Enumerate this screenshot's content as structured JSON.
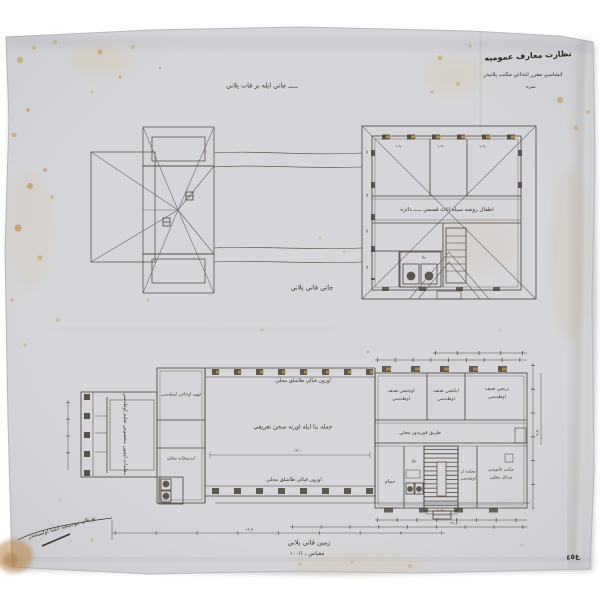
{
  "document": {
    "type": "scanned architectural drawing (Ottoman school plan)",
    "paper_color": "#d6d6da",
    "ink_color": "#463e34",
    "stain_color": "#c59a55",
    "background": "#ffffff"
  },
  "header": {
    "line1": "نظارت معارف عموميه",
    "line2": "انشاسي مقرر ابتدائي مكتب پلانيدر",
    "line3": "نمره"
  },
  "captions": {
    "top": "ـــــ چاتي ايله بر قات پلاني",
    "roof_floor": "چاتي قاتي پلاني",
    "ground_floor": "زمين قاتي پلاني",
    "scale": "مقياس ـ ١٠٠/١",
    "signature": "بو پلان موجبنجه انشا اولنمشدر",
    "corner_mark": "ع٤٥"
  },
  "upper_plan": {
    "corridor_label": "اطفال روضه سيله اناث قسمي ـــــ دائره",
    "window_dims": [
      "١،٩٠",
      "١،٩٠",
      "١،٩٠"
    ],
    "side_dims": [
      "٥",
      "٥",
      "٥",
      "٥"
    ],
    "wc_label": "حلا"
  },
  "lower_plan": {
    "hall_label": "جمله بنا ايله اورته صحن تعريفي",
    "veranda_top": "اوزون قپالي طاشلق محلي",
    "veranda_bottom": "اوزون قپالي طاشلق محلي",
    "corridor_label": "طريق قوريدور محلي",
    "left_room_vertical": "معلمات ايچون مخصوص تعليم اوطه‌سي",
    "tower_room_top": "قهوه اوجاغي اوطه‌سي",
    "tower_room_bottom": "ابدستخانه محلي",
    "classrooms": [
      {
        "line1": "اوچنجي صنف",
        "line2": "اوطه‌سي"
      },
      {
        "line1": "ايكنجي صنف",
        "line2": "اوطه‌سي"
      },
      {
        "line1": "برنجي صنف",
        "line2": "اوطه‌سي"
      }
    ],
    "hammam_label": "حمام",
    "wc_label": "حلا",
    "right_room_a": {
      "line1": "معلمه لر",
      "line2": "اوطه‌سي"
    },
    "right_room_b": {
      "line1": "مكتب قاپوسي",
      "line2": "مدخل محلي"
    },
    "dims": {
      "hall_width": "١٨،٠",
      "stair": "٤،٥٠",
      "total": "٢٢،٨٠",
      "left": "١٨،٥٠",
      "wing": "٩،٥٠"
    }
  }
}
